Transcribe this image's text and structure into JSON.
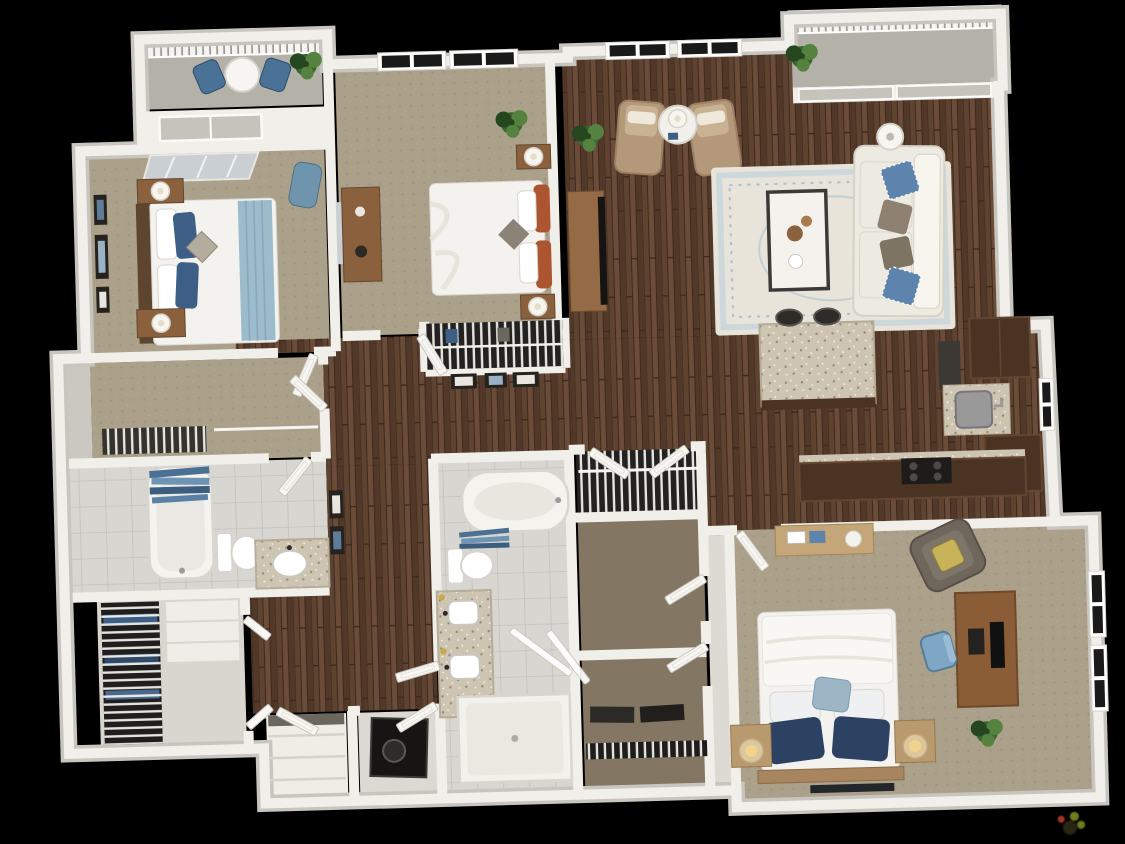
{
  "title": "3D apartment floor plan render",
  "canvas": {
    "width": 1125,
    "height": 844
  },
  "background": "#000000",
  "watermark": {
    "present": true,
    "legible": false
  },
  "palette": {
    "background": "#000000",
    "wall": "#f1efe9",
    "wall-edge": "#c7c5be",
    "wall-shadow": "#dcdad3",
    "wood-a": "#5f4331",
    "wood-b": "#6b4c38",
    "wood-c": "#523828",
    "wood-seam": "#3c2a1f",
    "carpet": "#aba089",
    "carpet-dot": "#988d77",
    "closet-carpet": "#837663",
    "tile": "#d7d6d0",
    "tile-line": "#c2c1bb",
    "balcony-floor": "#b4b1a8",
    "railing": "#f5f4f0",
    "railing-gap": "#9a978f",
    "granite": "#cdc5b2",
    "granite-dot1": "#958b73",
    "granite-dot2": "#f6f3ea",
    "cabinet": "#4a3322",
    "cabinet-edge": "#63462f",
    "sofa": "#edeae1",
    "sofa-shadow": "#d6d2c6",
    "pillow-blue": "#5d84ad",
    "pillow-blue-dark": "#3d5f86",
    "pillow-navy": "#2d4263",
    "pillow-taupe": "#8f8172",
    "rug": "#e8e4d9",
    "rug-accent": "#a3c0d4",
    "rug-border": "#cdd8dd",
    "tan-chair": "#b3997a",
    "tan-chair-dark": "#9c8263",
    "leather": "#6f665c",
    "bed-white": "#f3f2ee",
    "bed-fold": "#e6e4db",
    "bed-line": "#d8d6cd",
    "headboard": "#5e4530",
    "furn-wood": "#8a613c",
    "furn-wood-light": "#b08b5d",
    "desk-wood": "#8a5d36",
    "console-wood": "#c5a678",
    "orange": "#ad5530",
    "throw": "#9cbccc",
    "curtain": "#46698d",
    "plant": "#3a6632",
    "plant-light": "#55823f",
    "plant-dark": "#24471f",
    "glass-dark": "#1a1a1a",
    "glass-gray": "#c6c3ba",
    "mirror": "#c9cfd2",
    "metal": "#9b9a9b",
    "dark-item": "#26241f",
    "black": "#151413",
    "lamp-glow": "#f0d48e",
    "lamp-white": "#f7f5ef",
    "wm1": "#7a8c22",
    "wm2": "#b23a2a",
    "wm3": "#2f2b19"
  },
  "rooms": [
    {
      "id": "balcony-1",
      "type": "balcony",
      "items": [
        "railing",
        "bistro-table",
        "chair",
        "chair",
        "potted-plant"
      ]
    },
    {
      "id": "bedroom-1",
      "type": "bedroom",
      "items": [
        "queen-bed",
        "blue-pillows",
        "blue-throw",
        "nightstand-with-lamp",
        "nightstand-with-lamp",
        "mirrored-closet-doors",
        "wall-art",
        "accent-chair",
        "sliding-balcony-door"
      ]
    },
    {
      "id": "walk-in-closet-1",
      "type": "closet",
      "items": [
        "wire-shelving",
        "door"
      ]
    },
    {
      "id": "bathroom-2",
      "type": "bathroom",
      "items": [
        "bathtub",
        "blue-shower-curtain",
        "toilet",
        "vanity-sink"
      ]
    },
    {
      "id": "laundry-closet",
      "type": "laundry",
      "items": [
        "wire-shelving",
        "stacked-linens"
      ]
    },
    {
      "id": "bedroom-2",
      "type": "bedroom",
      "items": [
        "queen-bed",
        "orange-pillows",
        "nightstand-with-lamp",
        "nightstand-with-lamp",
        "dresser-with-mirror",
        "potted-plant",
        "reach-in-closet",
        "windows"
      ]
    },
    {
      "id": "hallway",
      "type": "hall",
      "items": [
        "doors",
        "wall-art-frames",
        "linen-closet",
        "utility-closet"
      ]
    },
    {
      "id": "living-room",
      "type": "living",
      "items": [
        "sofa",
        "throw-pillows",
        "area-rug",
        "coffee-table",
        "accent-chair",
        "accent-chair",
        "side-table-with-lamp",
        "tv-console",
        "tv",
        "floor-lamp",
        "potted-plant",
        "windows"
      ]
    },
    {
      "id": "balcony-2",
      "type": "balcony",
      "items": [
        "railing",
        "potted-plant",
        "sliding-glass-door"
      ]
    },
    {
      "id": "kitchen",
      "type": "kitchen",
      "items": [
        "granite-island",
        "bar-stool",
        "bar-stool",
        "sink",
        "upper-cabinets",
        "lower-cabinets",
        "refrigerator",
        "cooktop",
        "window"
      ]
    },
    {
      "id": "master-bedroom",
      "type": "bedroom",
      "items": [
        "king-bed",
        "navy-pillows",
        "nightstand-with-drum-lamp",
        "nightstand-with-drum-lamp",
        "desk-with-monitor",
        "office-chair",
        "armchair",
        "console-table",
        "potted-plant",
        "windows"
      ]
    },
    {
      "id": "master-bathroom",
      "type": "bathroom",
      "items": [
        "garden-tub",
        "blue-towels",
        "toilet",
        "double-vanity",
        "sconces",
        "walk-in-shower",
        "glass-door"
      ]
    },
    {
      "id": "closet-a",
      "type": "closet",
      "items": [
        "wire-shelving",
        "bifold-doors"
      ]
    },
    {
      "id": "closet-b",
      "type": "closet",
      "items": [
        "door"
      ]
    },
    {
      "id": "closet-c",
      "type": "closet",
      "items": [
        "door",
        "storage-boxes",
        "wire-shelving"
      ]
    }
  ]
}
